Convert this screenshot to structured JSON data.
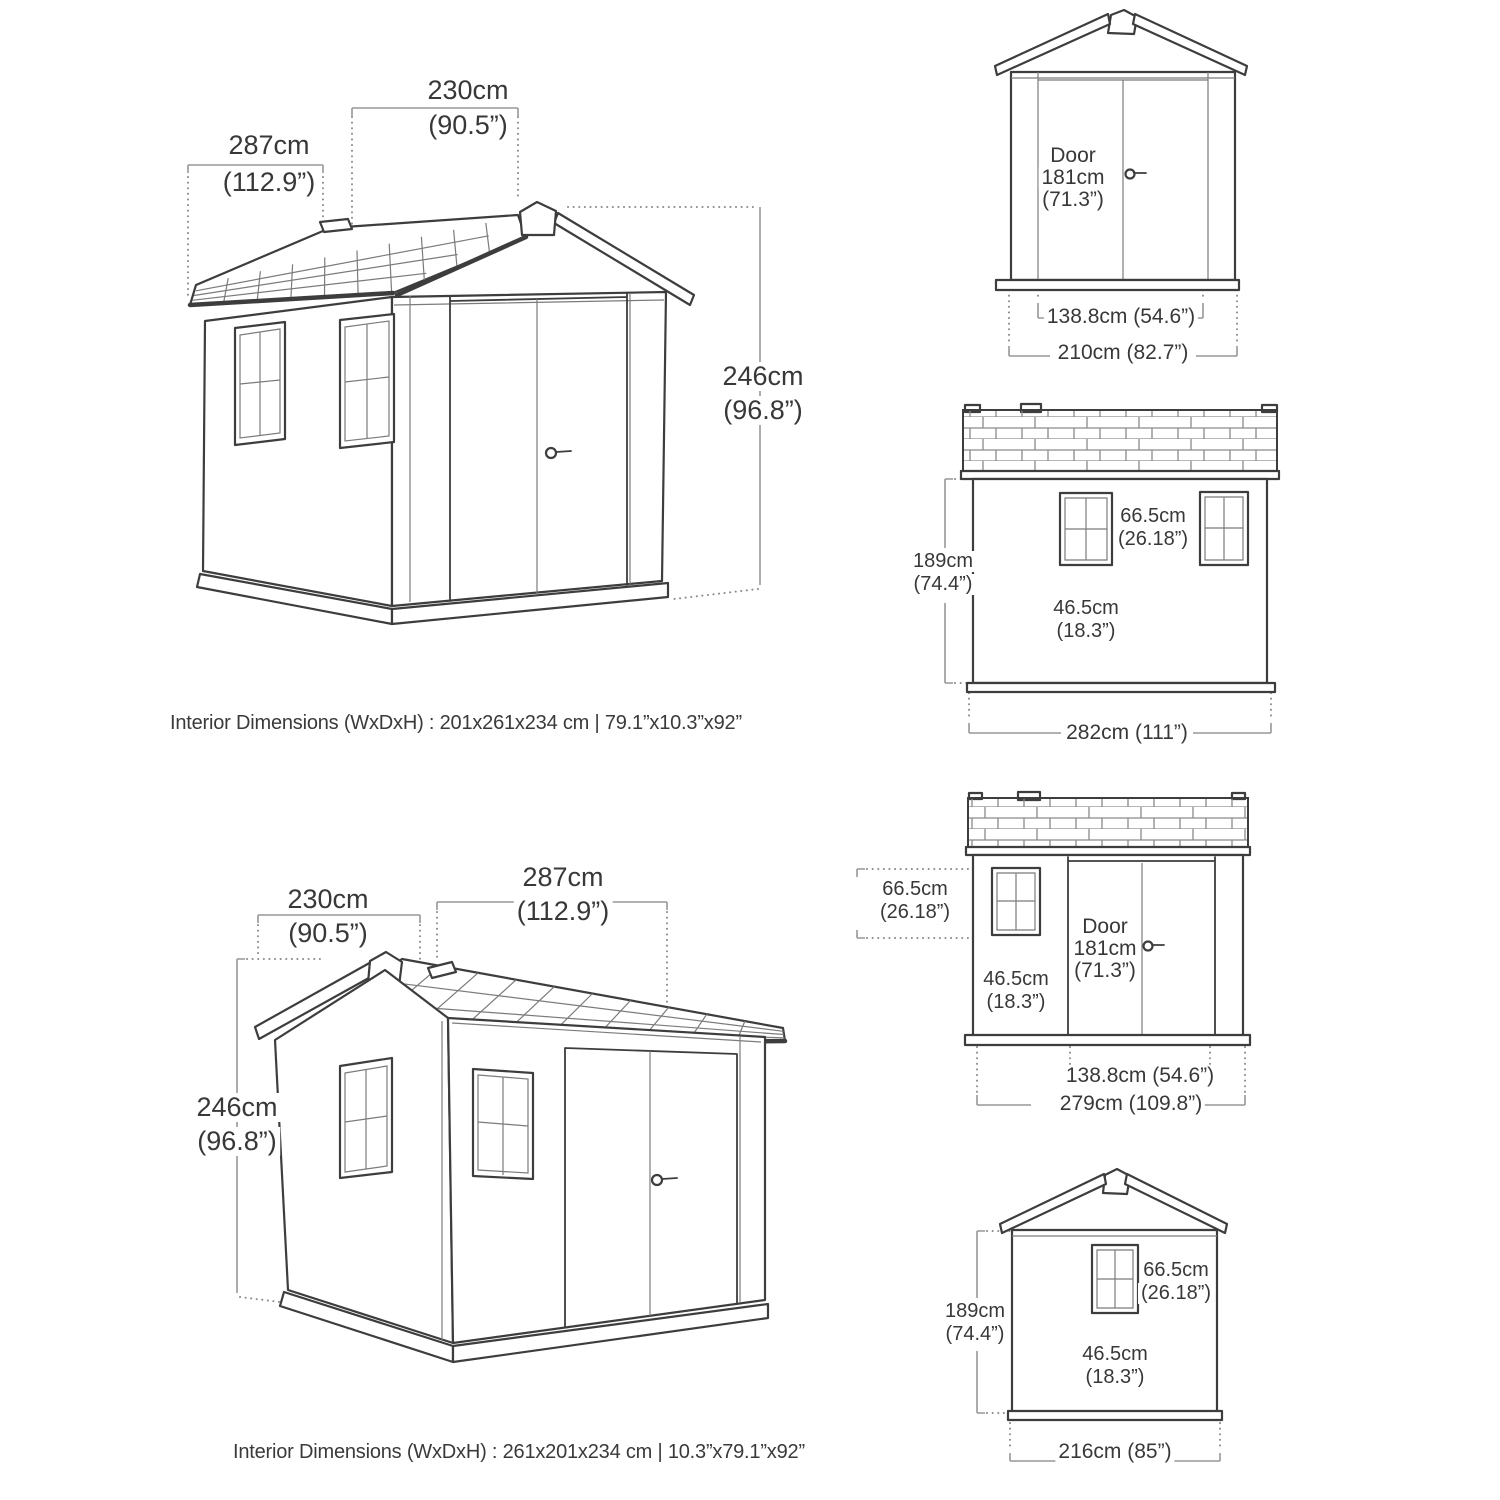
{
  "colors": {
    "background": "#ffffff",
    "line": "#3d3d3d",
    "line_thin": "#7b7b7b",
    "dimension_line": "#979797",
    "text": "#383838"
  },
  "captions": {
    "top": "Interior Dimensions (WxDxH) : 201x261x234 cm | 79.1”x10.3”x92”",
    "bottom": "Interior Dimensions (WxDxH) : 261x201x234 cm | 10.3”x79.1”x92”"
  },
  "persp_front": {
    "width_cm": "230cm",
    "width_in": "(90.5”)",
    "depth_cm": "287cm",
    "depth_in": "(112.9”)",
    "height_cm": "246cm",
    "height_in": "(96.8”)"
  },
  "front_door": {
    "door_line1": "Door",
    "door_line2": "181cm",
    "door_line3": "(71.3”)",
    "door_width": "138.8cm (54.6”)",
    "overall_width": "210cm (82.7”)"
  },
  "side_wall": {
    "height_cm": "189cm",
    "height_in": "(74.4”)",
    "win_h_cm": "66.5cm",
    "win_h_in": "(26.18”)",
    "win_w_cm": "46.5cm",
    "win_w_in": "(18.3”)",
    "overall_width": "282cm (111”)"
  },
  "side_door": {
    "win_h_cm": "66.5cm",
    "win_h_in": "(26.18”)",
    "win_w_cm": "46.5cm",
    "win_w_in": "(18.3”)",
    "door_line1": "Door",
    "door_line2": "181cm",
    "door_line3": "(71.3”)",
    "door_width": "138.8cm (54.6”)",
    "overall_width": "279cm (109.8”)"
  },
  "persp_side": {
    "width_cm": "230cm",
    "width_in": "(90.5”)",
    "depth_cm": "287cm",
    "depth_in": "(112.9”)",
    "height_cm": "246cm",
    "height_in": "(96.8”)"
  },
  "front_window": {
    "height_cm": "189cm",
    "height_in": "(74.4”)",
    "win_h_cm": "66.5cm",
    "win_h_in": "(26.18”)",
    "win_w_cm": "46.5cm",
    "win_w_in": "(18.3”)",
    "overall_width": "216cm (85”)"
  }
}
